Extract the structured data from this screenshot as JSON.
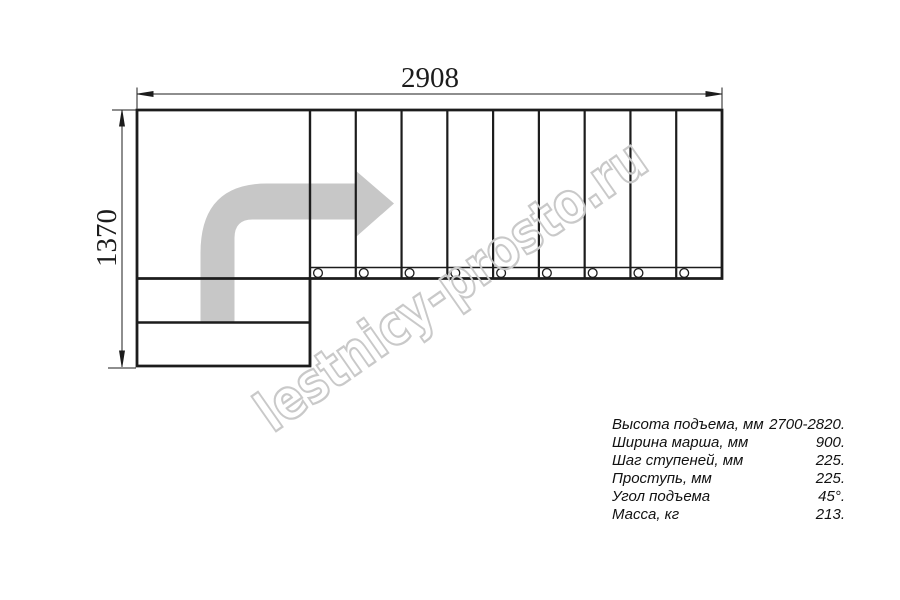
{
  "title": "L-shaped staircase plan drawing",
  "dimensions": {
    "overall_width_mm": "2908",
    "overall_depth_mm": "1370"
  },
  "plan": {
    "upper_flight_steps": 9,
    "lower_flight_steps": 2,
    "bolt_circles": 9,
    "turn_direction": "left-to-right, quarter turn"
  },
  "watermark": "lestnicy-prosto.ru",
  "specs": {
    "rows": [
      {
        "label": "Высота подъема, мм",
        "value": "2700-2820."
      },
      {
        "label": "Ширина марша, мм",
        "value": "900."
      },
      {
        "label": "Шаг ступеней, мм",
        "value": "225."
      },
      {
        "label": "Проступь, мм",
        "value": "225."
      },
      {
        "label": "Угол подъема",
        "value": "45°."
      },
      {
        "label": "Масса, кг",
        "value": "213."
      }
    ]
  },
  "colors": {
    "line": "#1c1c1c",
    "arrow_fill": "#c7c7c7",
    "watermark_stroke": "#c9c9c9"
  }
}
